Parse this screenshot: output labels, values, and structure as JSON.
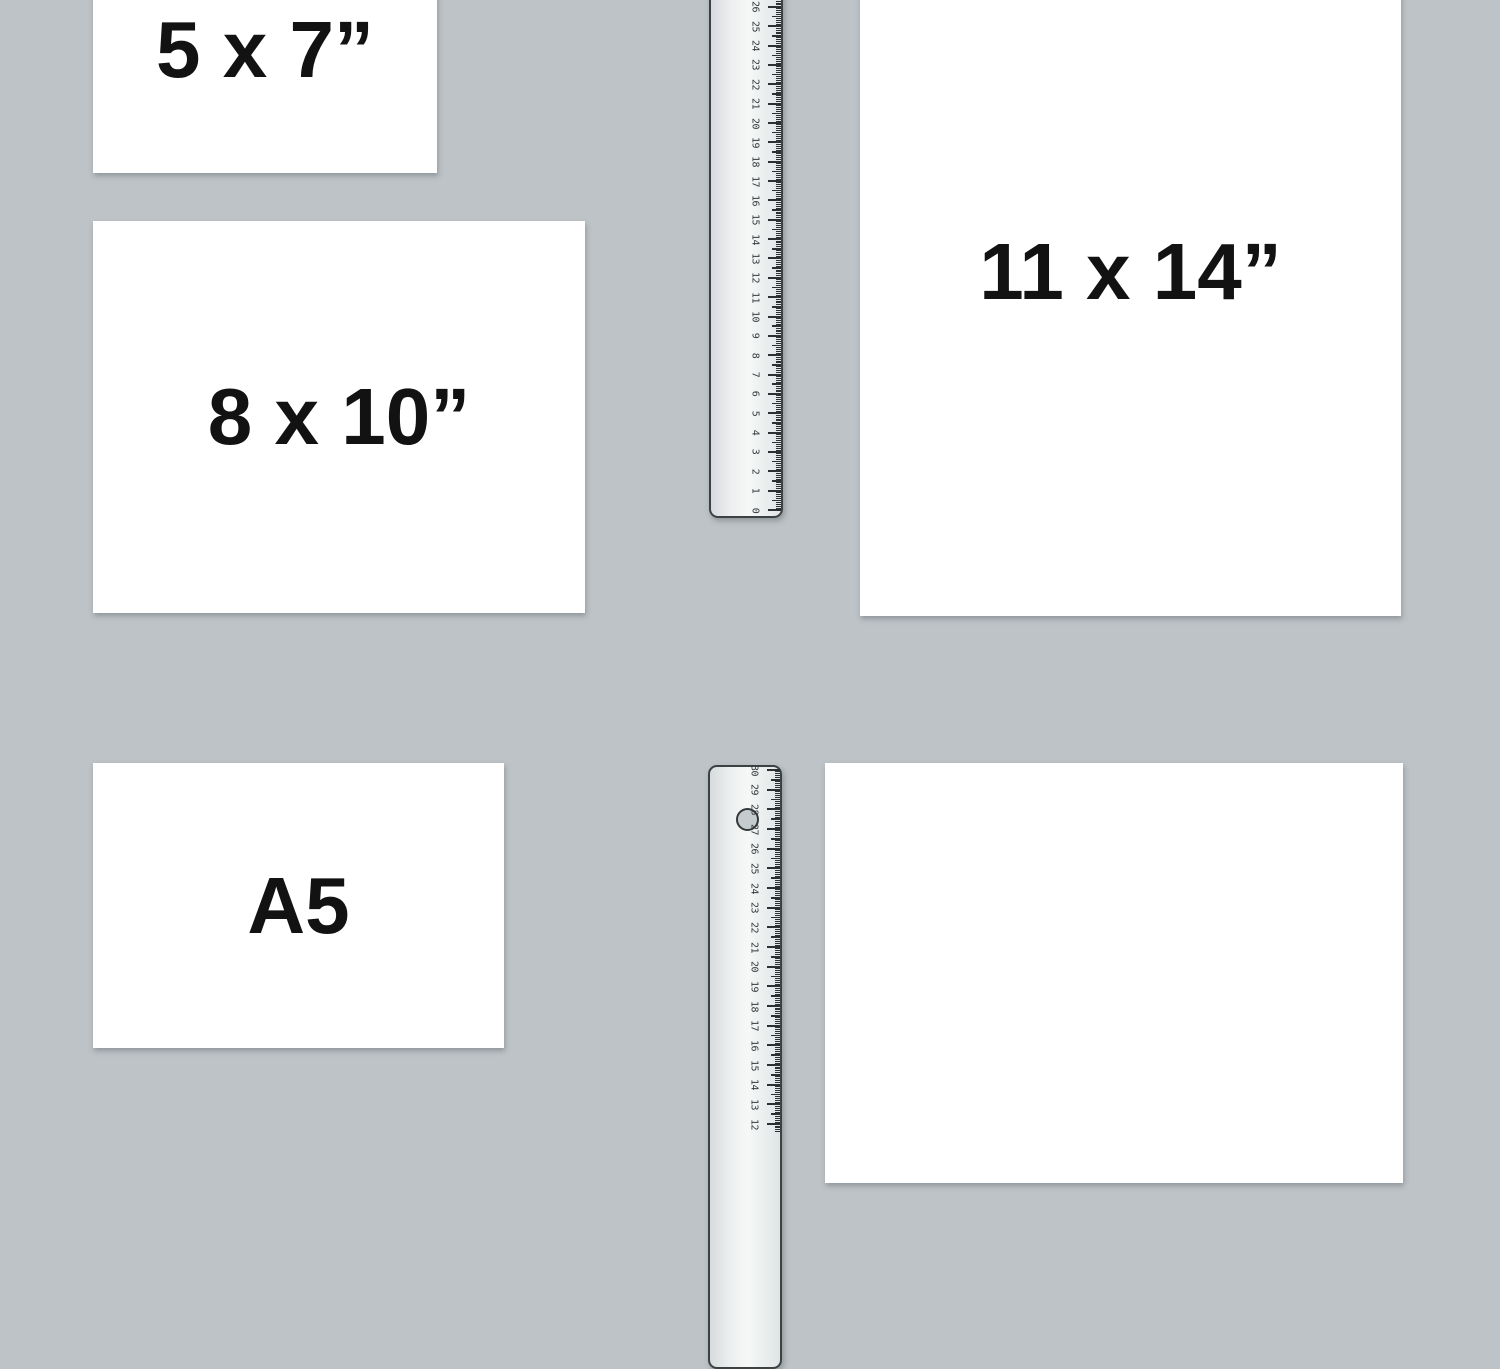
{
  "scene": {
    "background_color": "#bdc3c6",
    "paper_color": "#ffffff",
    "label_color": "#121212",
    "ruler_tick_color": "#2c3033"
  },
  "papers": [
    {
      "id": "5x7",
      "label": "5 x 7”"
    },
    {
      "id": "8x10",
      "label": "8 x 10”"
    },
    {
      "id": "11x14",
      "label": "11 x 14”"
    },
    {
      "id": "a5",
      "label": "A5"
    },
    {
      "id": "blank",
      "label": ""
    }
  ],
  "rulers": {
    "top": {
      "unit": "cm",
      "numbers": [
        "0",
        "1",
        "2",
        "3",
        "4",
        "5",
        "6",
        "7",
        "8",
        "9",
        "10",
        "11",
        "12",
        "13",
        "14",
        "15",
        "16",
        "17",
        "18",
        "19",
        "20",
        "21",
        "22",
        "23",
        "24",
        "25",
        "26"
      ]
    },
    "bottom": {
      "unit": "cm",
      "numbers": [
        "12",
        "13",
        "14",
        "15",
        "16",
        "17",
        "18",
        "19",
        "20",
        "21",
        "22",
        "23",
        "24",
        "25",
        "26",
        "27",
        "28",
        "29",
        "30"
      ]
    }
  }
}
